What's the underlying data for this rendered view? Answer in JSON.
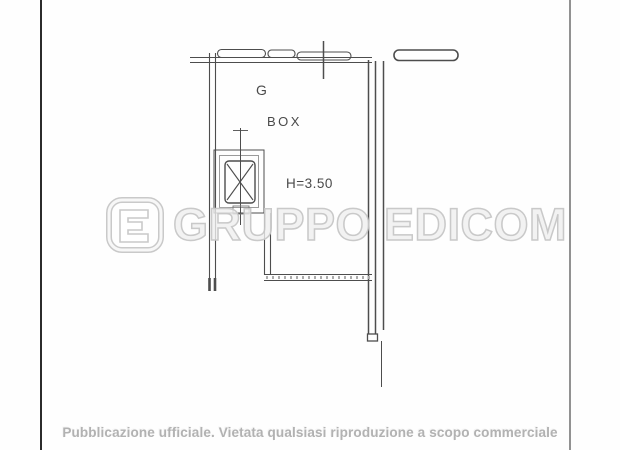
{
  "page": {
    "background": "#fefefe",
    "left_border_color": "#2b2b2b",
    "right_border_color": "#929292"
  },
  "floorplan": {
    "line_color": "#4d4d4d",
    "room_label": "BOX",
    "height_label": "H=3.50",
    "reference_label": "G"
  },
  "watermark": {
    "text": "GRUPPO EDICOM",
    "logo_icon": "edicom-logo",
    "stroke_color": "#c6c6c6"
  },
  "footer": {
    "notice": "Pubblicazione ufficiale. Vietata qualsiasi riproduzione a scopo commerciale"
  }
}
